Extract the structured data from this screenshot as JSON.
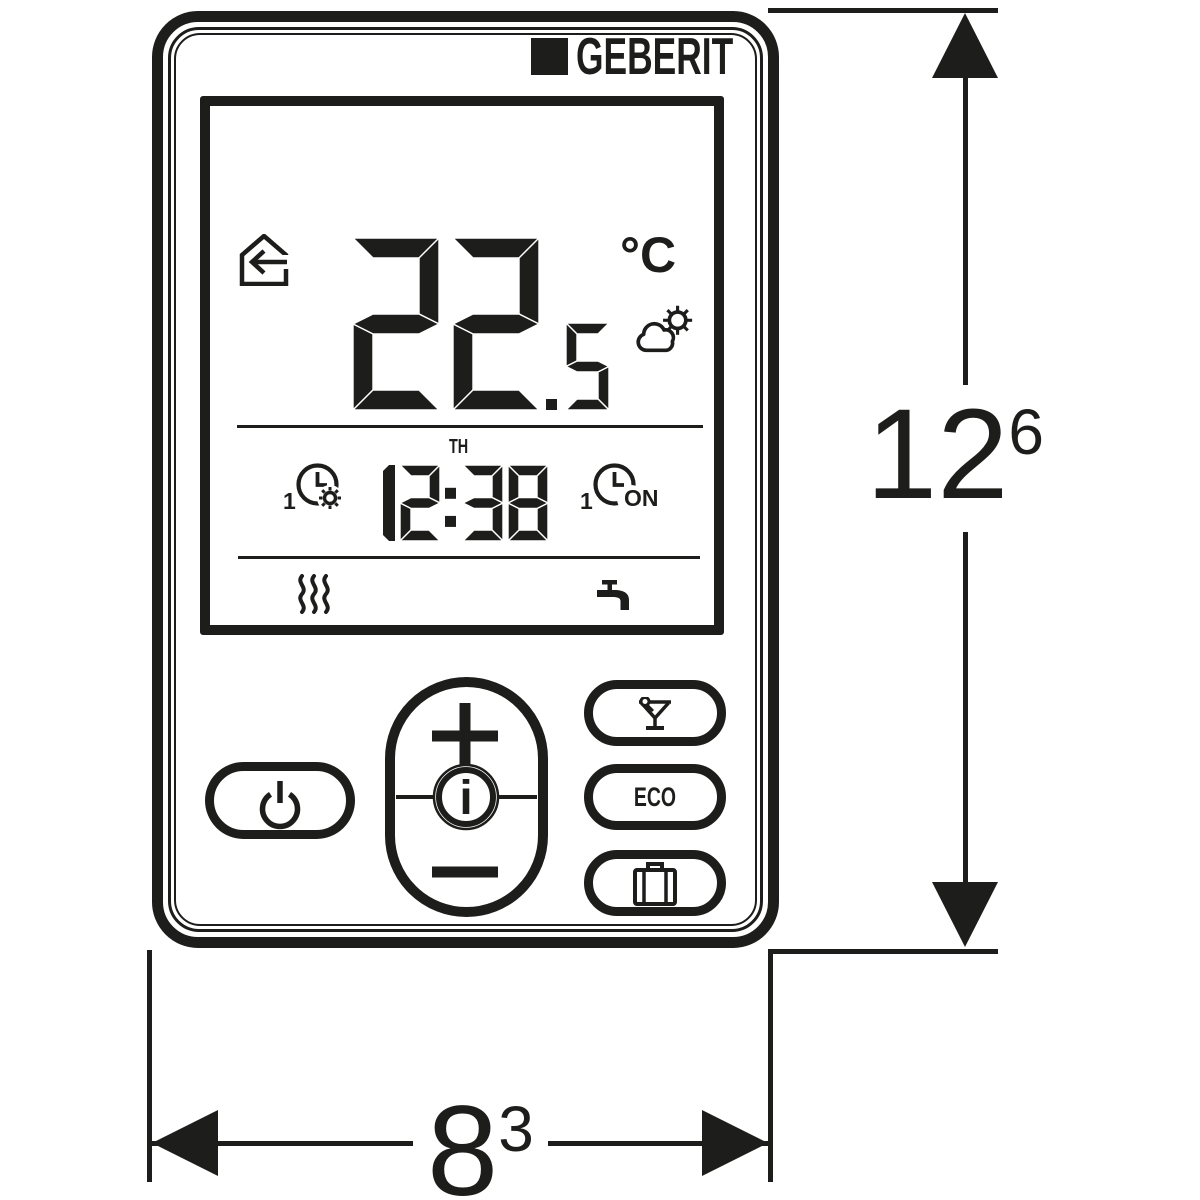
{
  "brand": {
    "logo_text": "GEBERIT",
    "logo_mark_icon": "black-square-icon"
  },
  "display": {
    "mode_icon": "house-arrow-icon",
    "temperature": {
      "integer": "22",
      "decimal": ".5",
      "unit": "°C"
    },
    "weather_icon": "sun-behind-cloud-icon",
    "heating_timer": {
      "index": "1",
      "icon": "clock-gear-icon"
    },
    "on_timer": {
      "index": "1",
      "icon": "clock-icon",
      "label": "ON"
    },
    "weekday": "TH",
    "time": "12:38",
    "heating_active_icon": "heating-waves-icon",
    "hot_water_icon": "tap-icon"
  },
  "controls": {
    "power": {
      "icon": "power-icon"
    },
    "rocker": {
      "plus": "+",
      "info": "i",
      "minus": "−"
    },
    "party": {
      "icon": "cocktail-icon"
    },
    "eco": {
      "label": "ECO"
    },
    "vacation": {
      "icon": "suitcase-icon"
    }
  },
  "dimensions": {
    "height": {
      "value": "12",
      "sup": "6"
    },
    "width": {
      "value": "8",
      "sup": "3"
    }
  },
  "colors": {
    "ink": "#1d1d1b",
    "background": "#ffffff"
  }
}
